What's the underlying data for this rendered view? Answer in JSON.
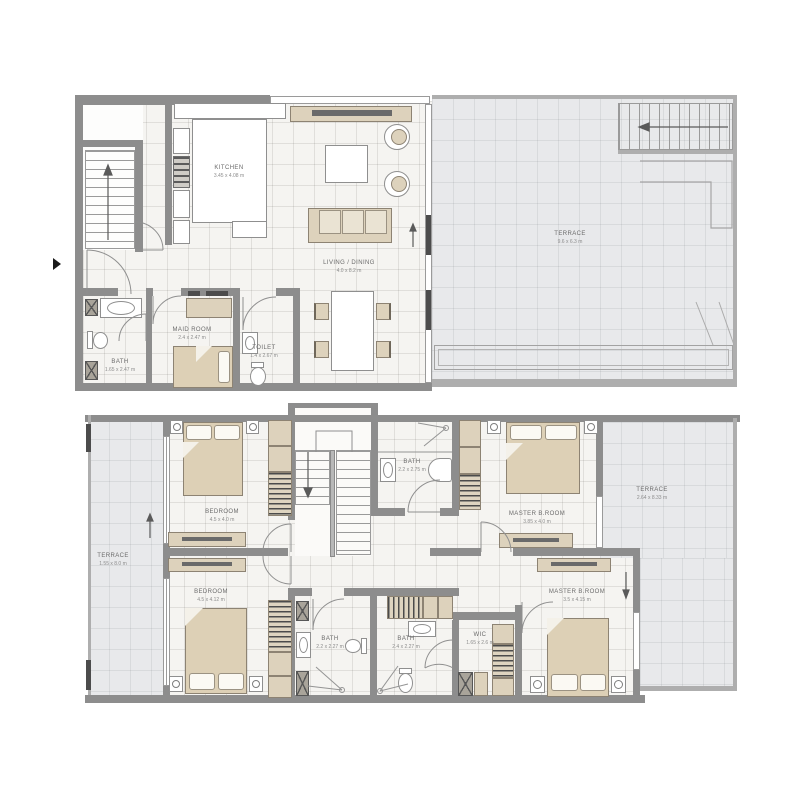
{
  "document": {
    "type": "architectural-floor-plan",
    "background": "#ffffff"
  },
  "palette": {
    "wall": "#8d8d8d",
    "wall_light": "#aeaeae",
    "floor": "#f5f4f1",
    "terrace_floor": "#e8e9eb",
    "furniture_tan": "#ddd2bc",
    "furniture_light": "#eae3d3",
    "fixture_white": "#ffffff",
    "label_text": "#6b6b6b",
    "dims_text": "#8d8d8d"
  },
  "plans": [
    {
      "id": "upper-plan",
      "rooms": [
        {
          "name": "KITCHEN",
          "dims": "3.45 x 4.08 m"
        },
        {
          "name": "LIVING / DINING",
          "dims": "4.0 x 8.2 m"
        },
        {
          "name": "TERRACE",
          "dims": "9.6 x 6.3 m"
        },
        {
          "name": "MAID ROOM",
          "dims": "2.4 x 2.47 m"
        },
        {
          "name": "BATH",
          "dims": "1.65 x 2.47 m"
        },
        {
          "name": "TOILET",
          "dims": "1.4 x 2.67 m"
        }
      ]
    },
    {
      "id": "bedroom-plan",
      "rooms": [
        {
          "name": "BEDROOM",
          "dims": "4.5 x 4.0 m"
        },
        {
          "name": "BEDROOM",
          "dims": "4.5 x 4.12 m"
        },
        {
          "name": "MASTER B.ROOM",
          "dims": "3.85 x 4.0 m"
        },
        {
          "name": "MASTER B.ROOM",
          "dims": "3.5 x 4.15 m"
        },
        {
          "name": "BATH",
          "dims": "2.2 x 2.75 m"
        },
        {
          "name": "BATH",
          "dims": "2.2 x 2.27 m"
        },
        {
          "name": "BATH",
          "dims": "2.4 x 2.27 m"
        },
        {
          "name": "WIC",
          "dims": "1.65 x 2.6 m"
        },
        {
          "name": "TERRACE",
          "dims": "1.55 x 8.0 m"
        },
        {
          "name": "TERRACE",
          "dims": "2.64 x 8.33 m"
        }
      ]
    }
  ]
}
